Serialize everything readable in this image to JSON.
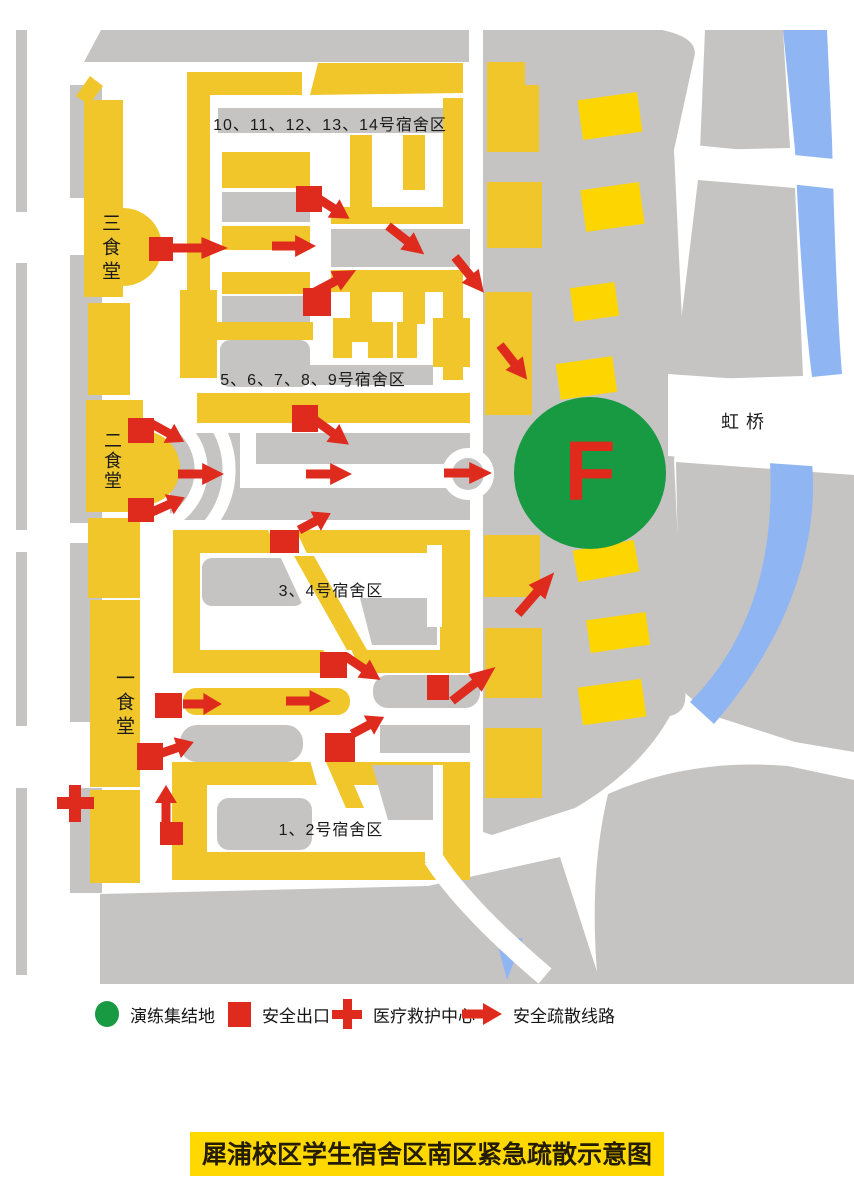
{
  "map": {
    "labels": {
      "dorm_10_14": "10、11、12、13、14号宿舍区",
      "dorm_5_9": "5、6、7、8、9号宿舍区",
      "dorm_3_4": "3、4号宿舍区",
      "dorm_1_2": "1、2号宿舍区",
      "canteen_3": "三食堂",
      "canteen_2": "二食堂",
      "canteen_1": "一食堂",
      "bridge": "虹桥",
      "assembly_point": "F"
    },
    "colors": {
      "building_yellow": "#f0c62a",
      "highlight_yellow": "#ffd800",
      "road_gray": "#c5c4c3",
      "water_blue": "#8fb5f2",
      "marker_red": "#df2b1e",
      "assembly_green": "#189a43"
    }
  },
  "legend": {
    "items": [
      {
        "icon": "assembly-circle",
        "label": "演练集结地"
      },
      {
        "icon": "exit-square",
        "label": "安全出口"
      },
      {
        "icon": "medical-cross",
        "label": "医疗救护中心"
      },
      {
        "icon": "evacuation-arrow",
        "label": "安全疏散线路"
      }
    ]
  },
  "title": {
    "text": "犀浦校区学生宿舍区南区紧急疏散示意图"
  }
}
